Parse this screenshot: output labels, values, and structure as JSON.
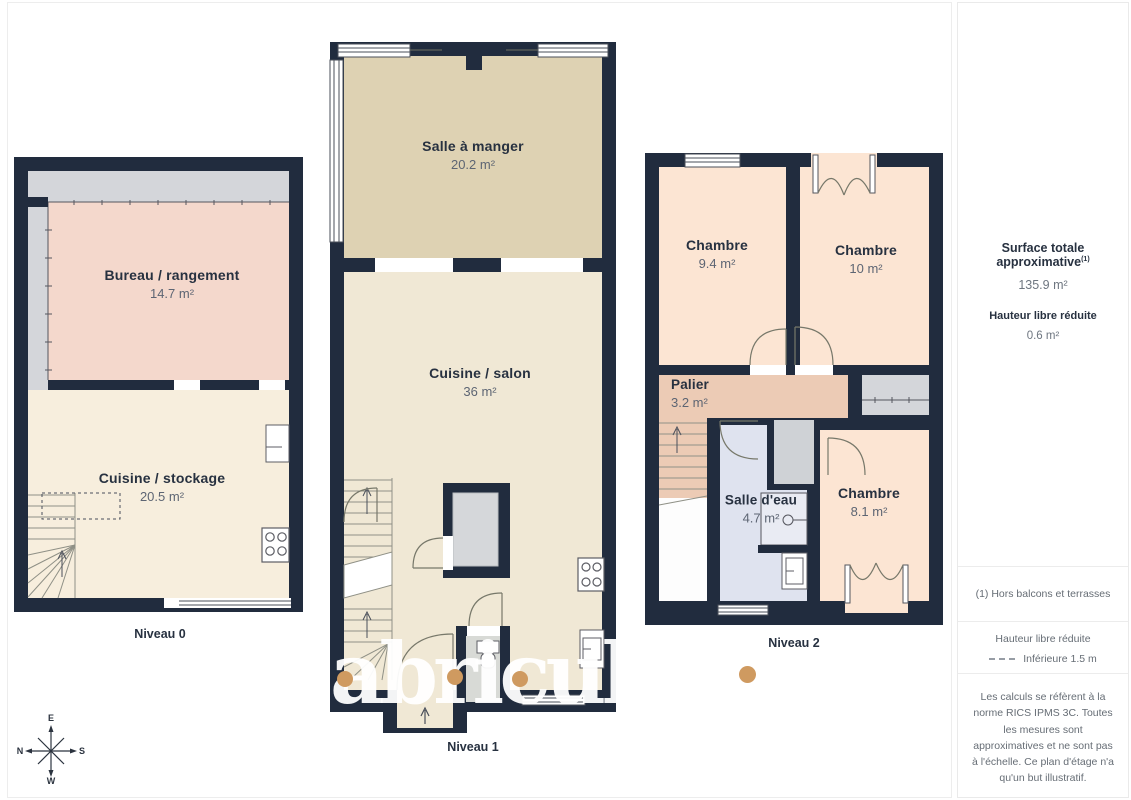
{
  "watermark": {
    "text": "abricult"
  },
  "plans": [
    {
      "label": "Niveau 0",
      "rooms": [
        {
          "name": "Bureau / rangement",
          "area": "14.7 m²"
        },
        {
          "name": "Cuisine / stockage",
          "area": "20.5 m²"
        }
      ]
    },
    {
      "label": "Niveau 1",
      "rooms": [
        {
          "name": "Salle à manger",
          "area": "20.2 m²"
        },
        {
          "name": "Cuisine / salon",
          "area": "36 m²"
        }
      ]
    },
    {
      "label": "Niveau 2",
      "rooms": [
        {
          "name": "Chambre",
          "area": "9.4 m²"
        },
        {
          "name": "Chambre",
          "area": "10 m²"
        },
        {
          "name": "Palier",
          "area": "3.2 m²"
        },
        {
          "name": "Salle d'eau",
          "area": "4.7 m²"
        },
        {
          "name": "Chambre",
          "area": "8.1 m²"
        }
      ]
    }
  ],
  "sidebar": {
    "surface_title": "Surface totale approximative",
    "surface_note_ref": "(1)",
    "surface_value": "135.9 m²",
    "reduced_height_title": "Hauteur libre réduite",
    "reduced_height_value": "0.6 m²",
    "footnote": "(1) Hors balcons et terrasses",
    "legend_title": "Hauteur libre réduite",
    "legend_item": "Inférieure 1.5 m",
    "disclaimer": "Les calculs se réfèrent à la norme RICS IPMS 3C. Toutes les mesures sont approximatives et ne sont pas à l'échelle. Ce plan d'étage n'a qu'un but illustratif.",
    "brand": "GIRAFFE",
    "brand_bold": "360"
  },
  "compass": {
    "top": "E",
    "bottom": "W",
    "left": "N",
    "right": "S"
  },
  "colors": {
    "wall": "#212c3e",
    "room_pink": "#f4d8cc",
    "room_cream_n0": "#f7eedd",
    "room_cream_n1": "#f0e8d5",
    "room_tan": "#ded2b3",
    "room_peach": "#fce5d3",
    "room_palier": "#eccbb5",
    "room_blue": "#dfe3ef",
    "closet_gray": "#d4d6da",
    "accent_orange": "#cf9a60",
    "label_text": "#273140"
  }
}
